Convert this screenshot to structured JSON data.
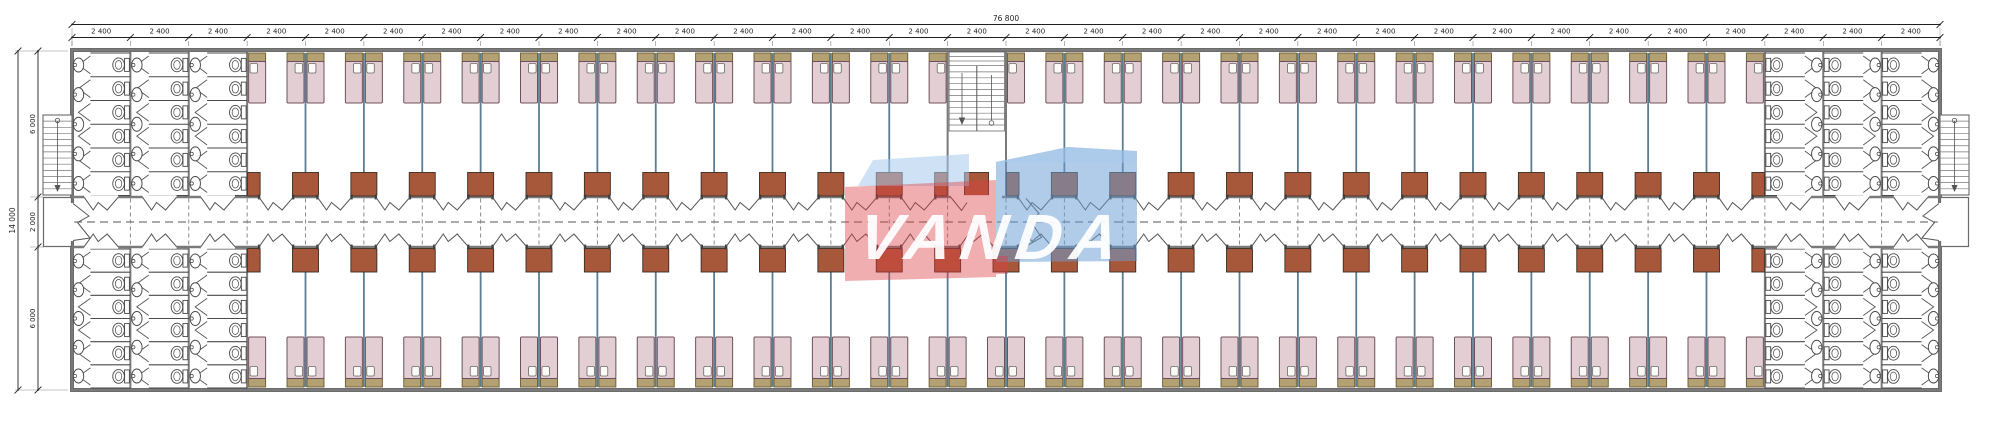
{
  "drawing": {
    "type": "architectural floor plan — dormitory block with central corridor, repeating 2 400 mm room modules, sanitary blocks at both ends, three staircases",
    "watermark": {
      "text": "VANDA"
    },
    "dimensions": {
      "top_total": "76 800",
      "top_module": "2 400",
      "module_count": 32,
      "left_total": "14 000",
      "left_segments": [
        "6 000",
        "2 000",
        "6 000"
      ]
    },
    "colors": {
      "wall": "#7a7a7a",
      "wall_edge": "#4d4d4d",
      "partition": "#5a7d92",
      "bed_fill": "#e2ced3",
      "bed_stroke": "#6d505c",
      "headboard_fill": "#b4a173",
      "headboard_stroke": "#6a5a2e",
      "pillow_fill": "#fbfaf7",
      "pillow_stroke": "#6a6a6a",
      "cabinet_fill": "#a8583a",
      "cabinet_stroke": "#3c2d24",
      "fixture_stroke": "#474747",
      "door": "#565656",
      "dash": "#6e6e6e",
      "dim": "#1f1f1f",
      "wm_red": "rgba(221,62,66,0.42)",
      "wm_blue": "rgba(106,157,212,0.52)",
      "wm_blue_light": "rgba(168,203,237,0.55)",
      "wm_text": "#ffffff"
    },
    "layout_counts": {
      "bands": 2,
      "rooms_top_band": 25,
      "rooms_bottom_band": 26,
      "beds_per_room": 2,
      "bathroom_columns_per_end": 3,
      "toilets_per_column_per_band": 6,
      "sinks_per_column_per_band": 5,
      "staircases": 3
    }
  }
}
